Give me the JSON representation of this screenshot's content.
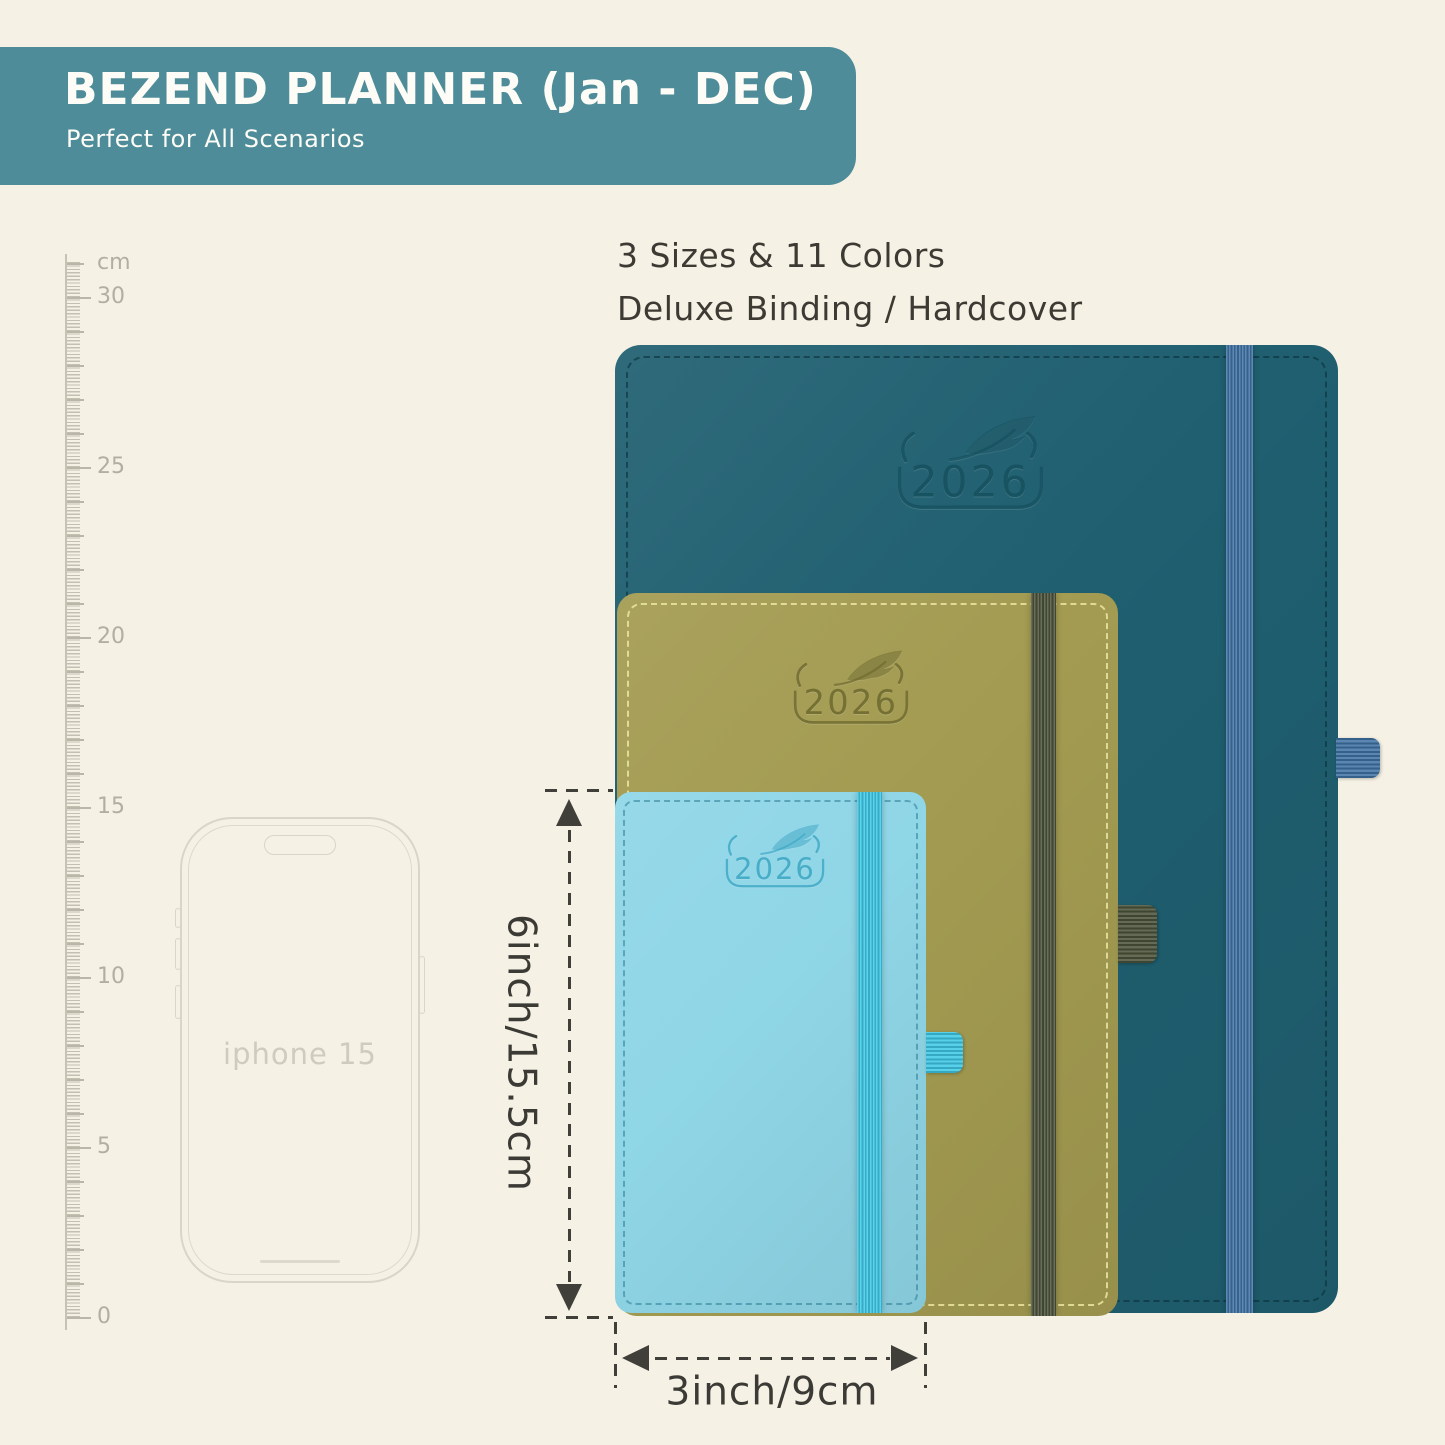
{
  "header": {
    "title": "BEZEND PLANNER (Jan - DEC)",
    "subtitle": "Perfect for All Scenarios",
    "bg_color": "#4d8c98"
  },
  "intro": {
    "line1": "3 Sizes & 11 Colors",
    "line2": "Deluxe Binding / Hardcover"
  },
  "ruler": {
    "unit": "cm",
    "labels": [
      30,
      25,
      20,
      15,
      10,
      5,
      0
    ],
    "max_cm": 31,
    "px_per_cm": 34,
    "zero_y": 1317
  },
  "phone": {
    "label": "iphone 15"
  },
  "planners": [
    {
      "name": "large-planner",
      "year": "2026",
      "cover": "#1f5f70",
      "band": "#3f72a4"
    },
    {
      "name": "medium-planner",
      "year": "2026",
      "cover": "#a39b51",
      "band": "#4a5239"
    },
    {
      "name": "small-planner",
      "year": "2026",
      "cover": "#8fd6e7",
      "band": "#3ec9e6"
    }
  ],
  "dimensions": {
    "height_label": "6inch/15.5cm",
    "width_label": "3inch/9cm"
  }
}
